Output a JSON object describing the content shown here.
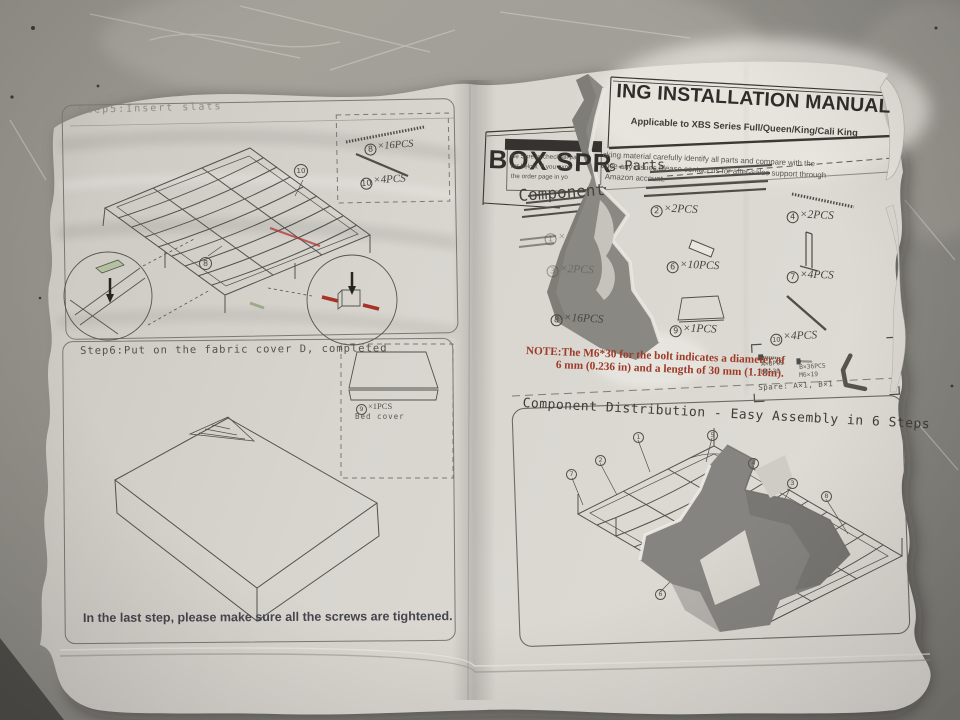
{
  "left_page": {
    "step5": {
      "heading": "Step5:Insert slats",
      "parts_box": {
        "rod_a": {
          "num": "8",
          "qty": "×16PCS"
        },
        "rod_b": {
          "num": "10",
          "qty": "×4PCS"
        }
      },
      "callouts": {
        "top": "10",
        "bottom": "8"
      }
    },
    "step6": {
      "heading": "Step6:Put on the fabric cover D, completed",
      "cover_part": {
        "num": "9",
        "qty": "×1PCS",
        "name": "Bed cover"
      },
      "footer": "In the last step,  please make sure all the screws are tightened."
    }
  },
  "right_page": {
    "title_fragment_left": "BOX SPR",
    "title_fragment_right": "ING INSTALLATION MANUAL",
    "subtitle": "Applicable to XBS Series Full/Queen/King/Cali King",
    "intro_lines": [
      "cking material carefully identify all parts and compare with the",
      "ence any issues.please contact us for after-sales support through",
      "Amazon account."
    ],
    "check_reminder_lines": [
      "Be Sure to check all pa",
      "list below. If you expe",
      "the order page in yo"
    ],
    "components_heading": {
      "left_fragment": "Component",
      "right_fragment": "s-Parts"
    },
    "parts": {
      "p1": {
        "num": "1",
        "qty": "×"
      },
      "p2": {
        "num": "2",
        "qty": "×2PCS"
      },
      "p3": {
        "num": "3",
        "qty": "×2PCS"
      },
      "p4": {
        "num": "4",
        "qty": "×2PCS"
      },
      "p6": {
        "num": "6",
        "qty": "×10PCS"
      },
      "p7": {
        "num": "7",
        "qty": "×4PCS"
      },
      "p8": {
        "num": "8",
        "qty": "×16PCS"
      },
      "p9": {
        "num": "9",
        "qty": "×1PCS"
      },
      "p10": {
        "num": "10",
        "qty": "×4PCS"
      }
    },
    "note_lines": [
      "NOTE:The M6*30 for the bolt indicates a diameter of",
      "6 mm (0.236 in) and a length of 30 mm (1.18in)."
    ],
    "hardware_box": {
      "a_label": "A×8PCS",
      "a_size": "M6×30",
      "b_label": "B×36PCS",
      "b_size": "M6×19",
      "spare": "Spare: A×1, B×1"
    },
    "assembly_heading": "Component Distribution - Easy Assembly in 6 Steps",
    "assembly_callouts": {
      "c1": "1",
      "c2": "2",
      "c3": "3",
      "c4": "4",
      "c5": "5",
      "c6": "6",
      "c7": "7",
      "c8": "8"
    }
  },
  "colors": {
    "note_red": "#9e3a28",
    "accent_red": "#b03434",
    "accent_green": "#8fa07c",
    "ink": "#4c4b46"
  }
}
